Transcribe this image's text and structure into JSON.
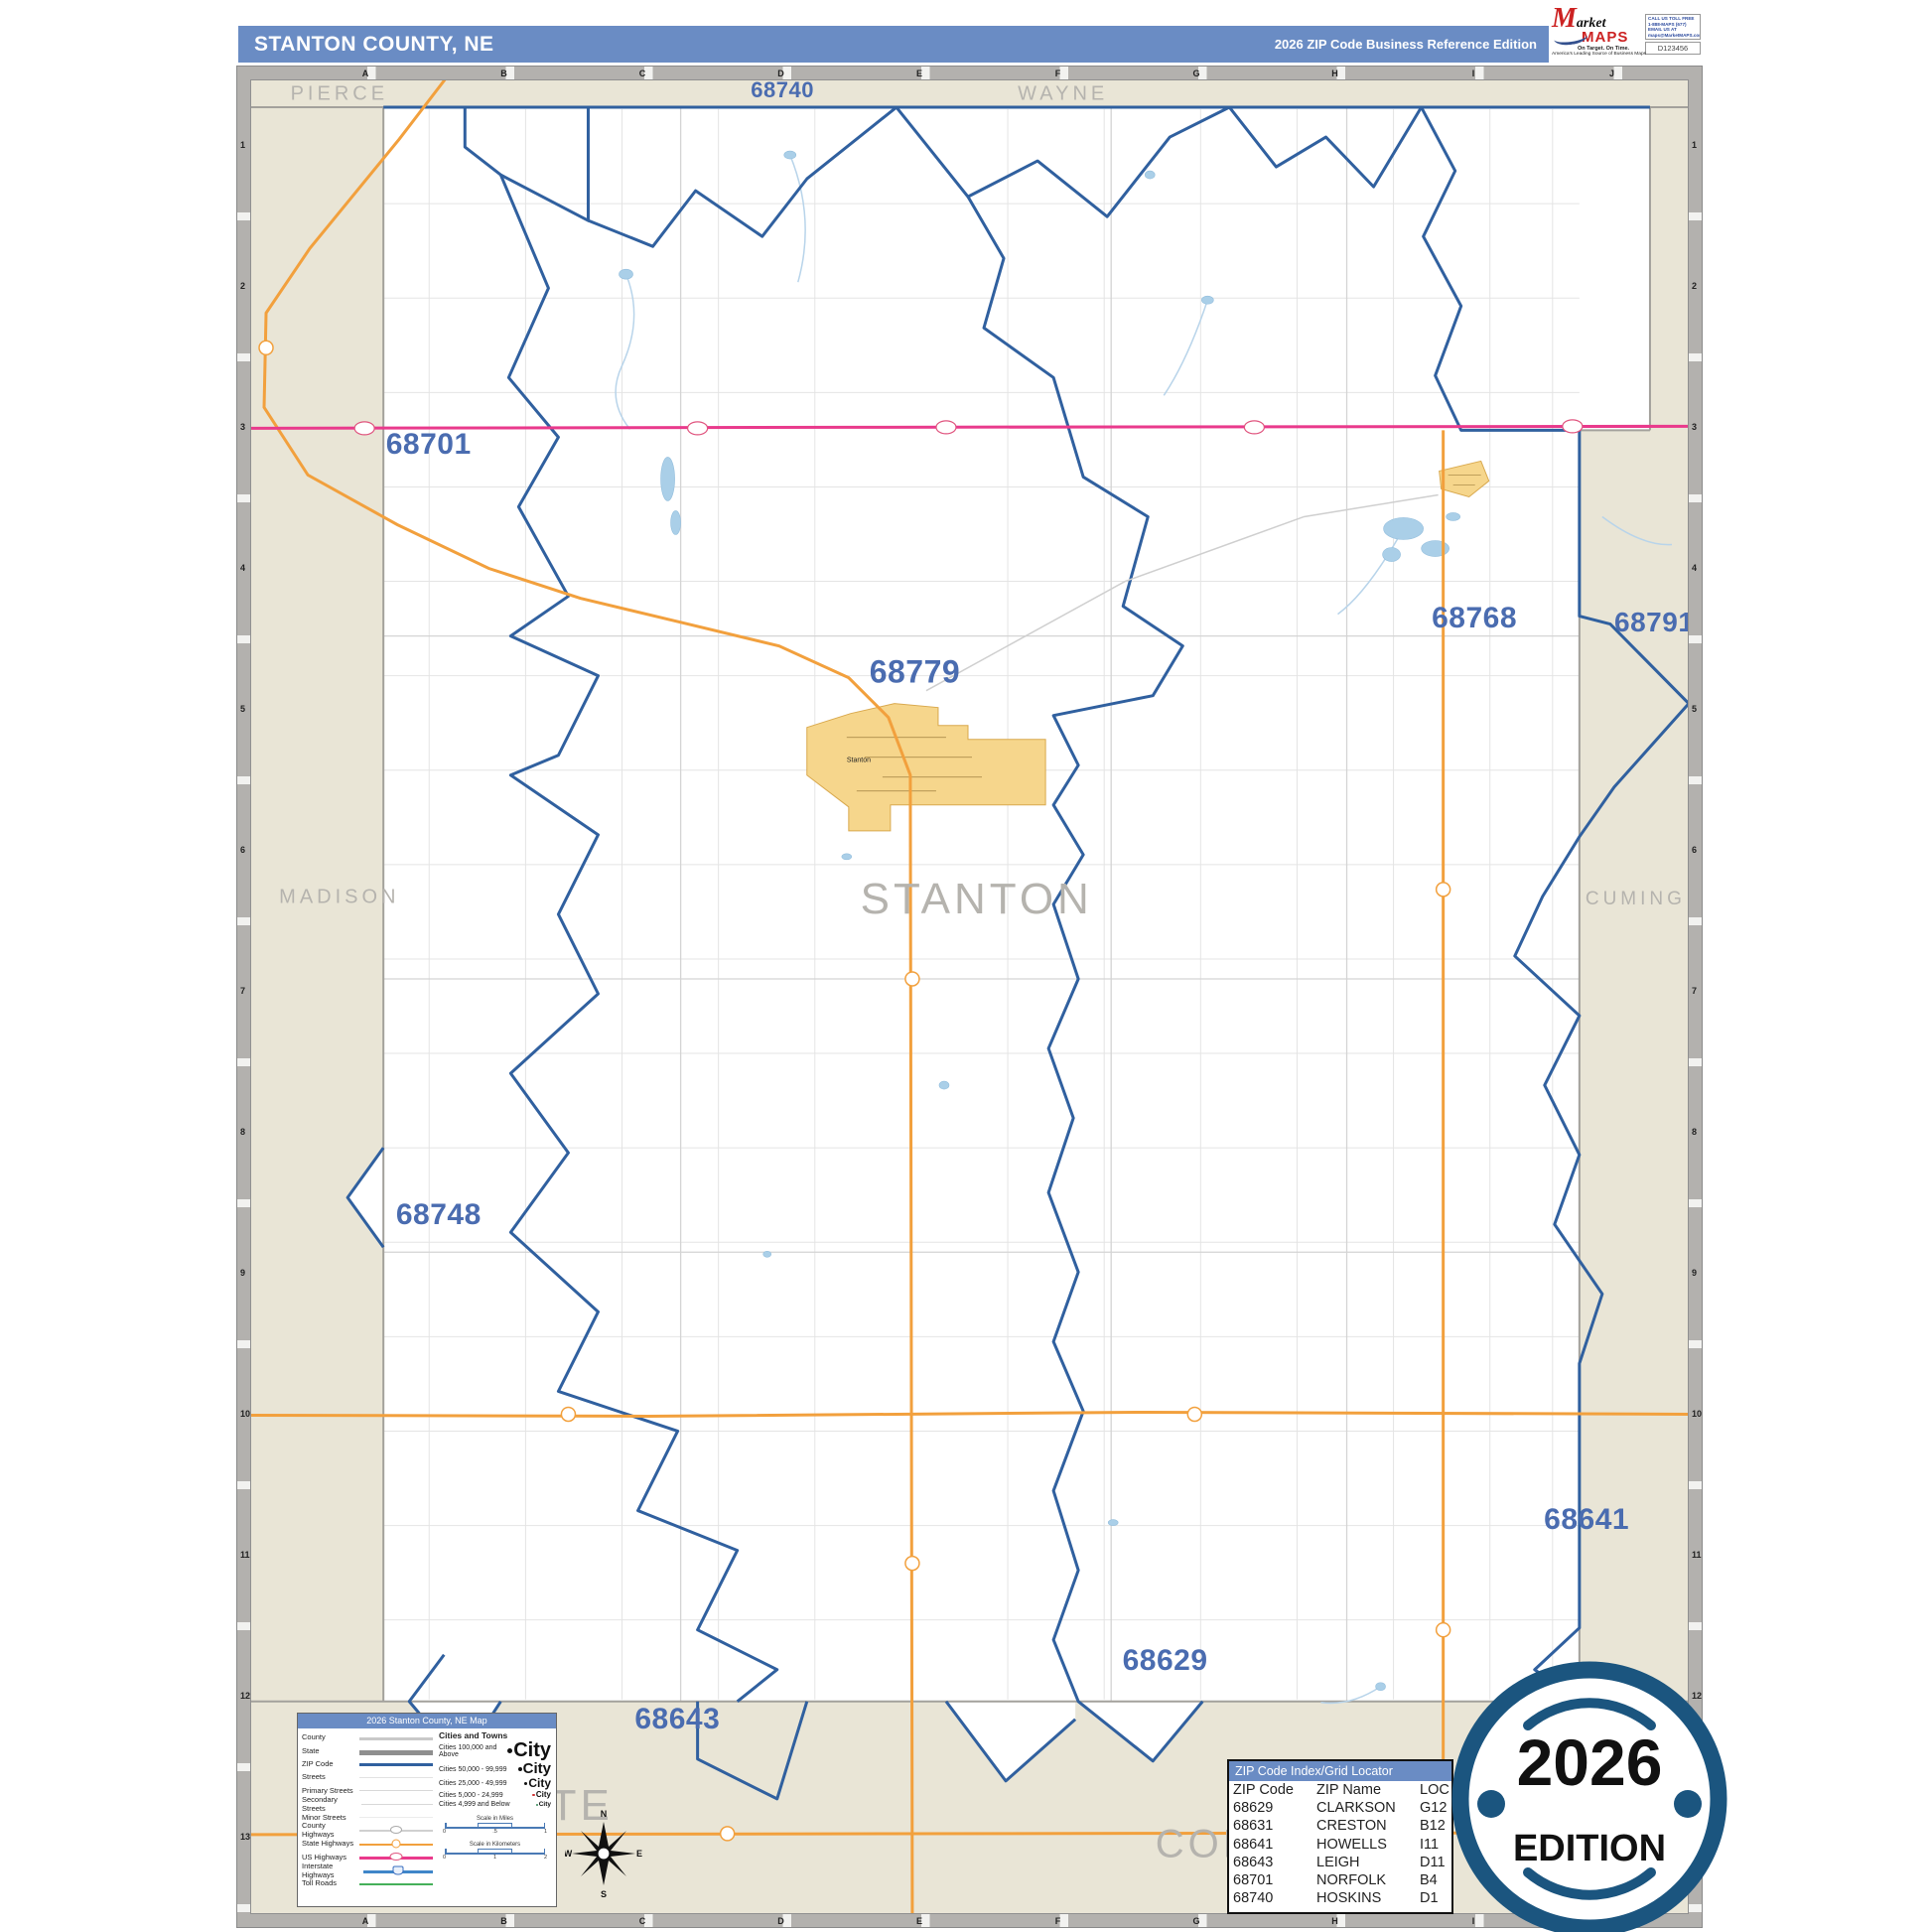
{
  "header": {
    "title": "STANTON COUNTY, NE",
    "edition": "2026 ZIP Code Business Reference Edition"
  },
  "logo": {
    "brand_market_initial": "M",
    "brand_market_rest": "arket",
    "brand_maps": "MAPS",
    "tagline": "On Target. On Time.",
    "subtitle": "America's Leading Source of Business Maps",
    "contact_call": "CALL US TOLL FREE",
    "contact_phone": "1-888-MAPS (677)",
    "contact_email_label": "EMAIL US AT",
    "contact_email": "maps@MarketMAPS.com",
    "code": "D123456"
  },
  "grid": {
    "columns": [
      "A",
      "B",
      "C",
      "D",
      "E",
      "F",
      "G",
      "H",
      "I",
      "J"
    ],
    "rows": [
      "1",
      "2",
      "3",
      "4",
      "5",
      "6",
      "7",
      "8",
      "9",
      "10",
      "11",
      "12",
      "13"
    ]
  },
  "map": {
    "county_labels": [
      {
        "name": "PIERCE",
        "x": 6.2,
        "y": 0.8,
        "fs": 20
      },
      {
        "name": "WAYNE",
        "x": 56.5,
        "y": 0.8,
        "fs": 20
      },
      {
        "name": "MADISON",
        "x": 6.2,
        "y": 44.6,
        "fs": 20
      },
      {
        "name": "STANTON",
        "x": 50.5,
        "y": 44.7,
        "fs": 44
      },
      {
        "name": "CUMING",
        "x": 96.3,
        "y": 44.7,
        "fs": 19
      },
      {
        "name": "PLATTE",
        "x": 18.8,
        "y": 94.1,
        "fs": 44
      },
      {
        "name": "COLFAX",
        "x": 69.2,
        "y": 96.2,
        "fs": 40
      }
    ],
    "zip_labels": [
      {
        "code": "68701",
        "x": 12.4,
        "y": 19.9,
        "fs": 30
      },
      {
        "code": "68740",
        "x": 37.0,
        "y": 0.6,
        "fs": 22
      },
      {
        "code": "68779",
        "x": 46.2,
        "y": 32.3,
        "fs": 32
      },
      {
        "code": "68768",
        "x": 85.1,
        "y": 29.4,
        "fs": 30
      },
      {
        "code": "68791",
        "x": 97.6,
        "y": 29.6,
        "fs": 28
      },
      {
        "code": "68748",
        "x": 13.1,
        "y": 61.9,
        "fs": 30
      },
      {
        "code": "68641",
        "x": 92.9,
        "y": 78.5,
        "fs": 30
      },
      {
        "code": "68629",
        "x": 63.6,
        "y": 86.2,
        "fs": 30
      },
      {
        "code": "68643",
        "x": 29.7,
        "y": 89.4,
        "fs": 30
      }
    ],
    "town_labels": [
      {
        "name": "Stanton",
        "x": 42.3,
        "y": 37.1,
        "fs": 7
      }
    ]
  },
  "legend": {
    "title": "2026 Stanton County, NE Map",
    "line_items": [
      {
        "label": "County",
        "style": "county"
      },
      {
        "label": "State",
        "style": "state"
      },
      {
        "label": "ZIP Code",
        "style": "zip"
      },
      {
        "label": "Streets",
        "style": "streets"
      },
      {
        "label": "Primary Streets",
        "style": "primary"
      },
      {
        "label": "Secondary Streets",
        "style": "secondary"
      },
      {
        "label": "Minor Streets",
        "style": "minor"
      },
      {
        "label": "County Highways",
        "style": "county-hwy"
      },
      {
        "label": "State Highways",
        "style": "state-hwy"
      },
      {
        "label": "US Highways",
        "style": "us-hwy"
      },
      {
        "label": "Interstate Highways",
        "style": "interstate"
      },
      {
        "label": "Toll Roads",
        "style": "toll"
      }
    ],
    "cities_header": "Cities and Towns",
    "city_sample": "City",
    "city_items": [
      {
        "label": "Cities 100,000 and Above",
        "size": "s1"
      },
      {
        "label": "Cities 50,000 - 99,999",
        "size": "s2"
      },
      {
        "label": "Cities 25,000 - 49,999",
        "size": "s3"
      },
      {
        "label": "Cities 5,000 - 24,999",
        "size": "s4"
      },
      {
        "label": "Cities 4,999 and Below",
        "size": "s5"
      }
    ],
    "scale_miles": {
      "label": "Scale in Miles",
      "ticks": [
        "0",
        ".5",
        "1"
      ]
    },
    "scale_km": {
      "label": "Scale in Kilometers",
      "ticks": [
        "0",
        "1",
        "2"
      ]
    }
  },
  "zip_index": {
    "title": "ZIP Code Index/Grid Locator",
    "columns": [
      "ZIP Code",
      "ZIP Name",
      "LOC"
    ],
    "rows": [
      {
        "zip": "68629",
        "name": "CLARKSON",
        "loc": "G12"
      },
      {
        "zip": "68631",
        "name": "CRESTON",
        "loc": "B12"
      },
      {
        "zip": "68641",
        "name": "HOWELLS",
        "loc": "I11"
      },
      {
        "zip": "68643",
        "name": "LEIGH",
        "loc": "D11"
      },
      {
        "zip": "68701",
        "name": "NORFOLK",
        "loc": "B4"
      },
      {
        "zip": "68740",
        "name": "HOSKINS",
        "loc": "D1"
      }
    ]
  },
  "badge": {
    "year": "2026",
    "edition": "EDITION"
  },
  "compass": {
    "n": "N",
    "e": "E",
    "s": "S",
    "w": "W"
  },
  "colors": {
    "header_blue": "#6a8cc4",
    "zip_boundary_blue": "#30609f",
    "zip_label_blue": "#4a6cb0",
    "county_label_gray": "#b5b3ae",
    "neighbor_beige": "#e9e5d6",
    "us_highway_pink": "#e93a8c",
    "state_highway_orange": "#f2a03d",
    "lake_blue": "#aacfe8",
    "town_yellow": "#f6d68c",
    "badge_navy": "#1b557f"
  }
}
